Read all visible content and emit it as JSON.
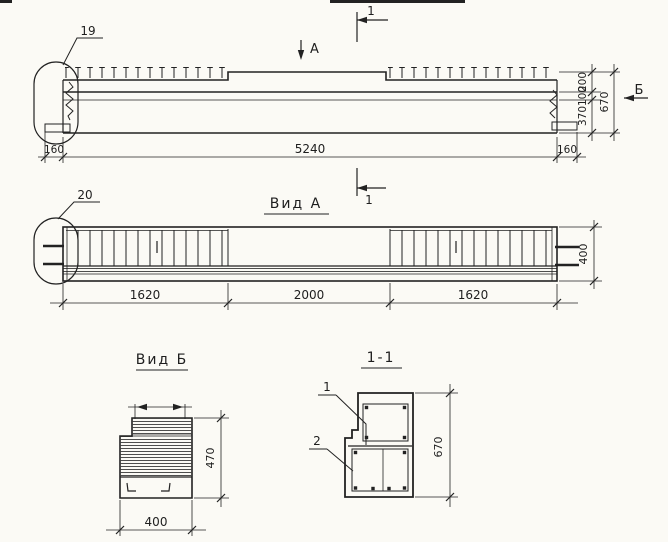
{
  "elevation": {
    "callout": "19",
    "section_label": "1",
    "view_label": "А",
    "side_label": "Б",
    "dims": {
      "overhang_left": "160",
      "length": "5240",
      "overhang_right": "160",
      "h_top": "200",
      "h_mid": "100",
      "h_bottom": "370",
      "h_total": "670"
    }
  },
  "plan": {
    "title": "Вид А",
    "callout": "20",
    "section_label": "1",
    "dims": {
      "seg_left": "1620",
      "seg_mid": "2000",
      "seg_right": "1620",
      "width": "400"
    }
  },
  "end_view": {
    "title": "Вид Б",
    "dims": {
      "width": "400",
      "height": "470"
    }
  },
  "section": {
    "title": "1-1",
    "bar_top_label": "1",
    "bar_bottom_label": "2",
    "dims": {
      "height": "670"
    }
  },
  "colors": {
    "paper": "#fbfaf5",
    "ink": "#222222"
  }
}
